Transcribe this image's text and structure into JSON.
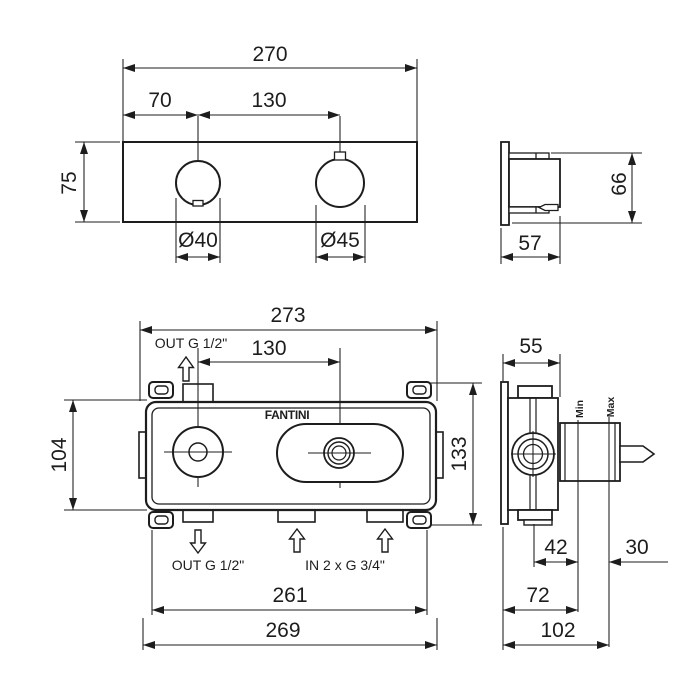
{
  "page": {
    "background": "#ffffff",
    "line_color": "#1d1d1d"
  },
  "views": {
    "trim_front": {
      "dim_width": "270",
      "dim_knob_offset": "70",
      "dim_centers": "130",
      "dim_height": "75",
      "dim_knob1_dia": "Ø40",
      "dim_knob2_dia": "Ø45"
    },
    "trim_side": {
      "dim_height": "66",
      "dim_depth": "57"
    },
    "rough_front": {
      "brand": "FANTINI",
      "label_out_top": "OUT G 1/2\"",
      "label_out_bottom": "OUT G 1/2\"",
      "label_in_bottom": "IN 2 x G 3/4\"",
      "dim_width_overall": "273",
      "dim_centers": "130",
      "dim_height_body": "104",
      "dim_height_overall": "133",
      "dim_ports_span": "261",
      "dim_body_width": "269"
    },
    "rough_side": {
      "label_min": "Min",
      "label_max": "Max",
      "dim_depth": "55",
      "dim_center_to_min": "42",
      "dim_min_to_max": "30",
      "dim_wall_to_min": "72",
      "dim_wall_to_max": "102"
    }
  }
}
